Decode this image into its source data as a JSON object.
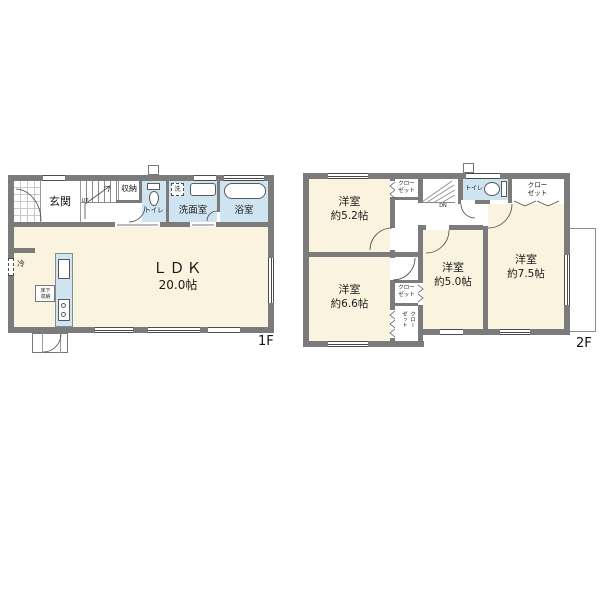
{
  "colors": {
    "wall": "#7b7b7b",
    "room_cream": "#faf3df",
    "room_wet_blue": "#cfe4f1",
    "background": "#ffffff"
  },
  "floor1": {
    "label": "1F",
    "entrance": "玄関",
    "storage": "収納",
    "toilet": "トイレ",
    "washroom": "洗面室",
    "bathroom": "浴室",
    "washer": "洗",
    "ldk_name": "ＬＤＫ",
    "ldk_size": "20.0帖",
    "fridge": "冷",
    "floor_storage": "床下収納",
    "stairs_dir": "UP"
  },
  "floor2": {
    "label": "2F",
    "stairs_dir": "DN",
    "toilet": "トイレ",
    "rooms": {
      "r52": {
        "name": "洋室",
        "size": "約5.2帖"
      },
      "r66": {
        "name": "洋室",
        "size": "約6.6帖"
      },
      "r50": {
        "name": "洋室",
        "size": "約5.0帖"
      },
      "r75": {
        "name": "洋室",
        "size": "約7.5帖"
      }
    },
    "closets": {
      "a": "クローゼット",
      "b": "クローゼット",
      "c": "クローゼット",
      "d": "クローゼット"
    }
  }
}
